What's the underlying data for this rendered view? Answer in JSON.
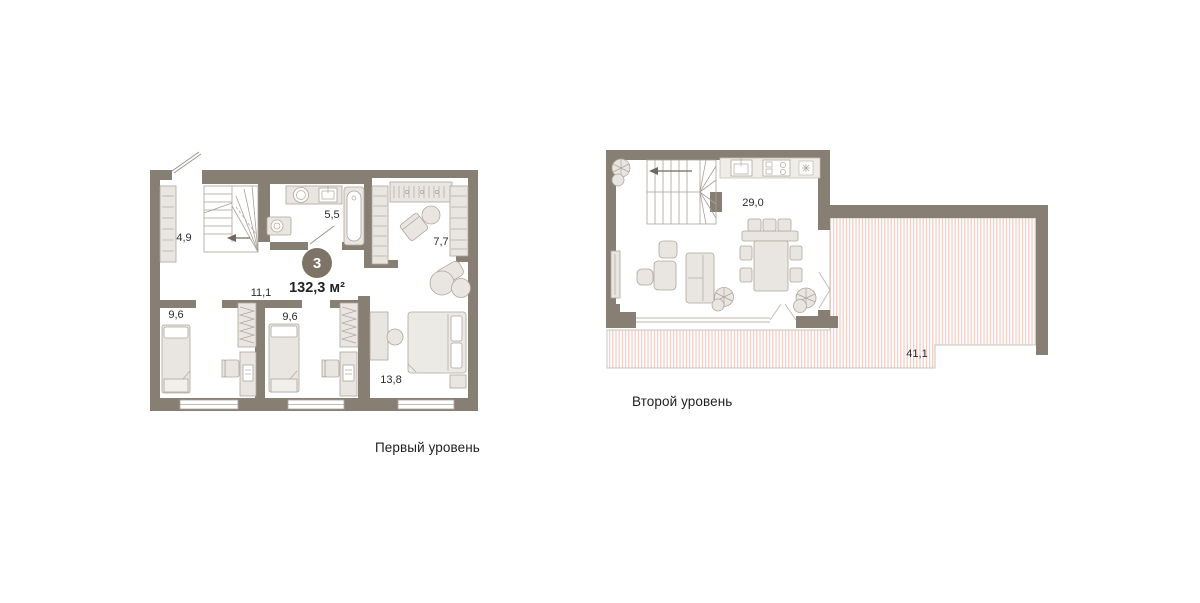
{
  "levels": [
    {
      "caption": "Первый уровень",
      "badge": {
        "number": "3",
        "area_total": "132,3 м²"
      },
      "rooms": {
        "hallway": "4,9",
        "bathroom": "5,5",
        "dressing": "7,7",
        "corridor": "11,1",
        "bedroom_left": "9,6",
        "bedroom_middle": "9,6",
        "bedroom_master": "13,8"
      }
    },
    {
      "caption": "Второй уровень",
      "rooms": {
        "living_kitchen": "29,0",
        "terrace": "41,1"
      }
    }
  ],
  "colors": {
    "wall": "#877E74",
    "furniture_fill": "#E9E6E2",
    "furniture_stroke": "#AEA69C",
    "terrace_hatch": "#F2BDB2",
    "terrace_border": "#C9C4BE",
    "badge_bg": "#7D7366",
    "label_text": "#2B2B2B"
  }
}
